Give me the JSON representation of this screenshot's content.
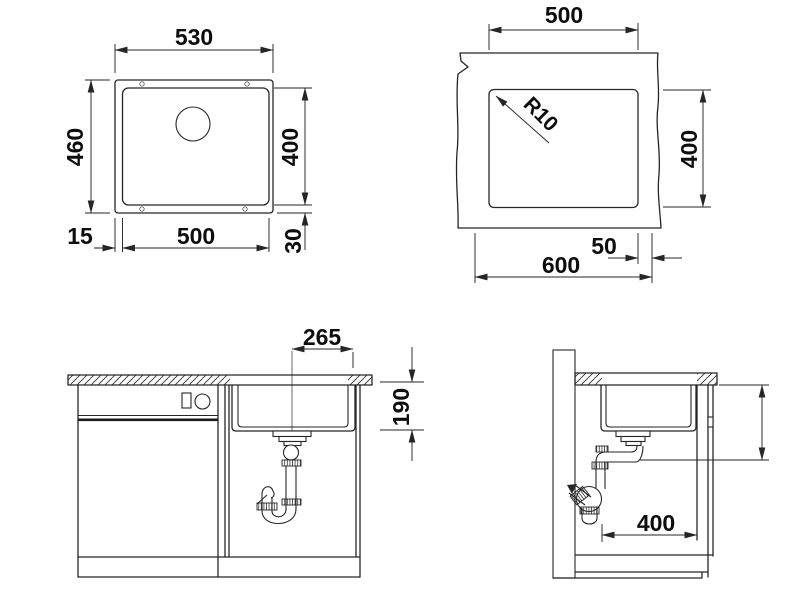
{
  "document": {
    "type": "sink-installation-technical-drawing",
    "background": "#ffffff",
    "line_color": "#262626",
    "text_color": "#0d0d0d"
  },
  "views": {
    "top": {
      "name": "sink-top-view",
      "dims": {
        "width_top": "530",
        "height_left": "460",
        "bowl_height": "400",
        "bowl_width": "500",
        "offset_left": "15",
        "offset_bottom": "30"
      }
    },
    "cutout": {
      "name": "worktop-cutout-view",
      "dims": {
        "width": "500",
        "corner_radius": "R10",
        "depth": "400",
        "edge_offset": "50",
        "cabinet_width": "600"
      }
    },
    "front": {
      "name": "cabinet-front-view",
      "dims": {
        "drain_offset": "265",
        "bowl_depth": "190"
      }
    },
    "side": {
      "name": "cabinet-side-view",
      "dims": {
        "bowl_length": "400"
      }
    }
  }
}
